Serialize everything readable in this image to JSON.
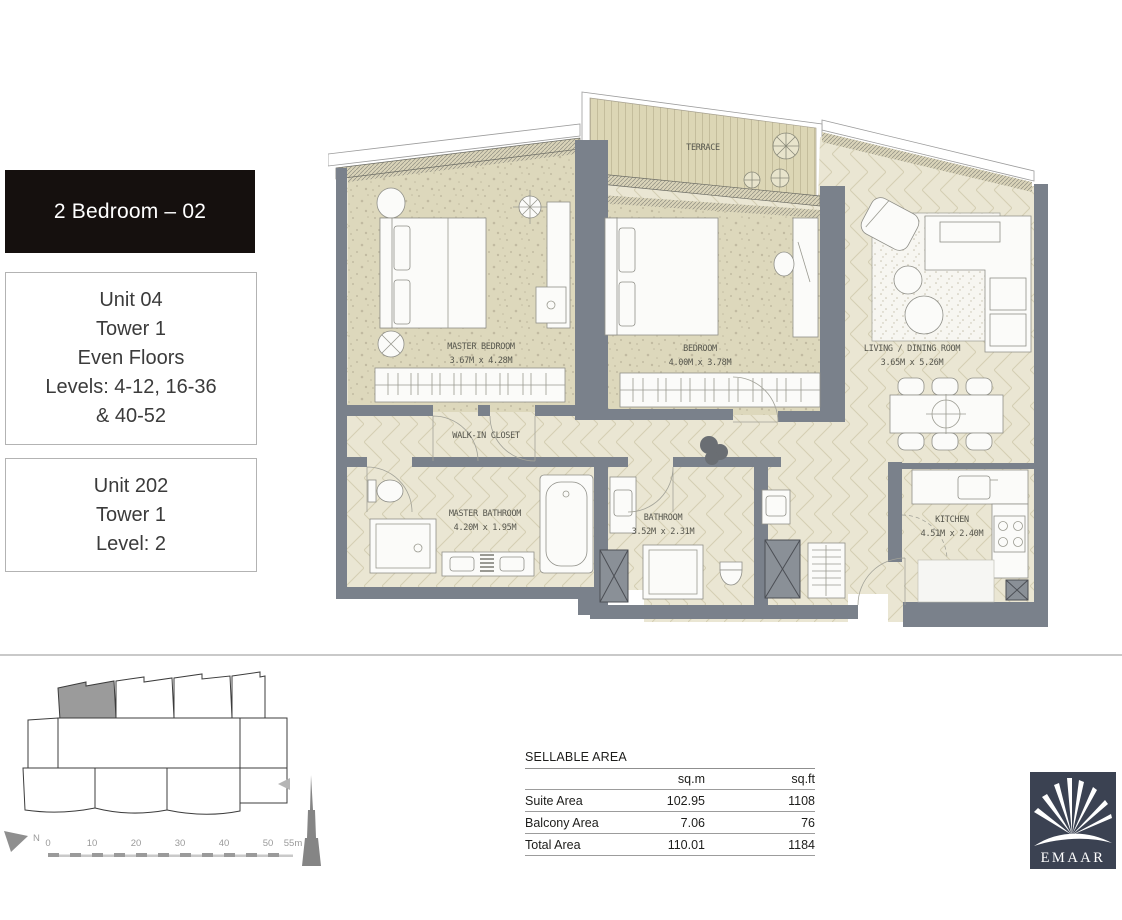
{
  "colors": {
    "wall": "#7a818b",
    "floor_speckle": "#ddd8bc",
    "floor_herringbone": "#eae6d3",
    "herringbone_line": "#d4ceb3",
    "terrace_deck": "#dcd6b5",
    "terrace_line": "#c4bd9c",
    "accent_dark": "#15100e",
    "logo_bg": "#3b4252",
    "line_grey": "#c9c9c9"
  },
  "title_box": {
    "label": "2 Bedroom – 02"
  },
  "unit_boxes": [
    {
      "lines": [
        "Unit 04",
        "Tower 1",
        "Even Floors",
        "Levels: 4-12, 16-36",
        "& 40-52"
      ]
    },
    {
      "lines": [
        "Unit 202",
        "Tower 1",
        "Level: 2"
      ]
    }
  ],
  "floor_plan": {
    "rooms": [
      {
        "name": "TERRACE",
        "dims": ""
      },
      {
        "name": "MASTER BEDROOM",
        "dims": "3.67M x 4.28M"
      },
      {
        "name": "BEDROOM",
        "dims": "4.00M x 3.78M"
      },
      {
        "name": "LIVING / DINING ROOM",
        "dims": "3.65M x 5.26M"
      },
      {
        "name": "WALK-IN CLOSET",
        "dims": ""
      },
      {
        "name": "MASTER BATHROOM",
        "dims": "4.20M x 1.95M"
      },
      {
        "name": "BATHROOM",
        "dims": "3.52M x 2.31M"
      },
      {
        "name": "KITCHEN",
        "dims": "4.51M x 2.40M"
      }
    ]
  },
  "key_plan": {
    "north_label": "N",
    "scale_ticks": [
      "0",
      "10",
      "20",
      "30",
      "40",
      "50",
      "55m"
    ]
  },
  "area_table": {
    "title": "SELLABLE AREA",
    "col_headers": [
      "sq.m",
      "sq.ft"
    ],
    "rows": [
      {
        "label": "Suite Area",
        "sqm": "102.95",
        "sqft": "1108"
      },
      {
        "label": "Balcony Area",
        "sqm": "7.06",
        "sqft": "76"
      },
      {
        "label": "Total Area",
        "sqm": "110.01",
        "sqft": "1184"
      }
    ]
  },
  "logo": {
    "brand": "EMAAR"
  }
}
